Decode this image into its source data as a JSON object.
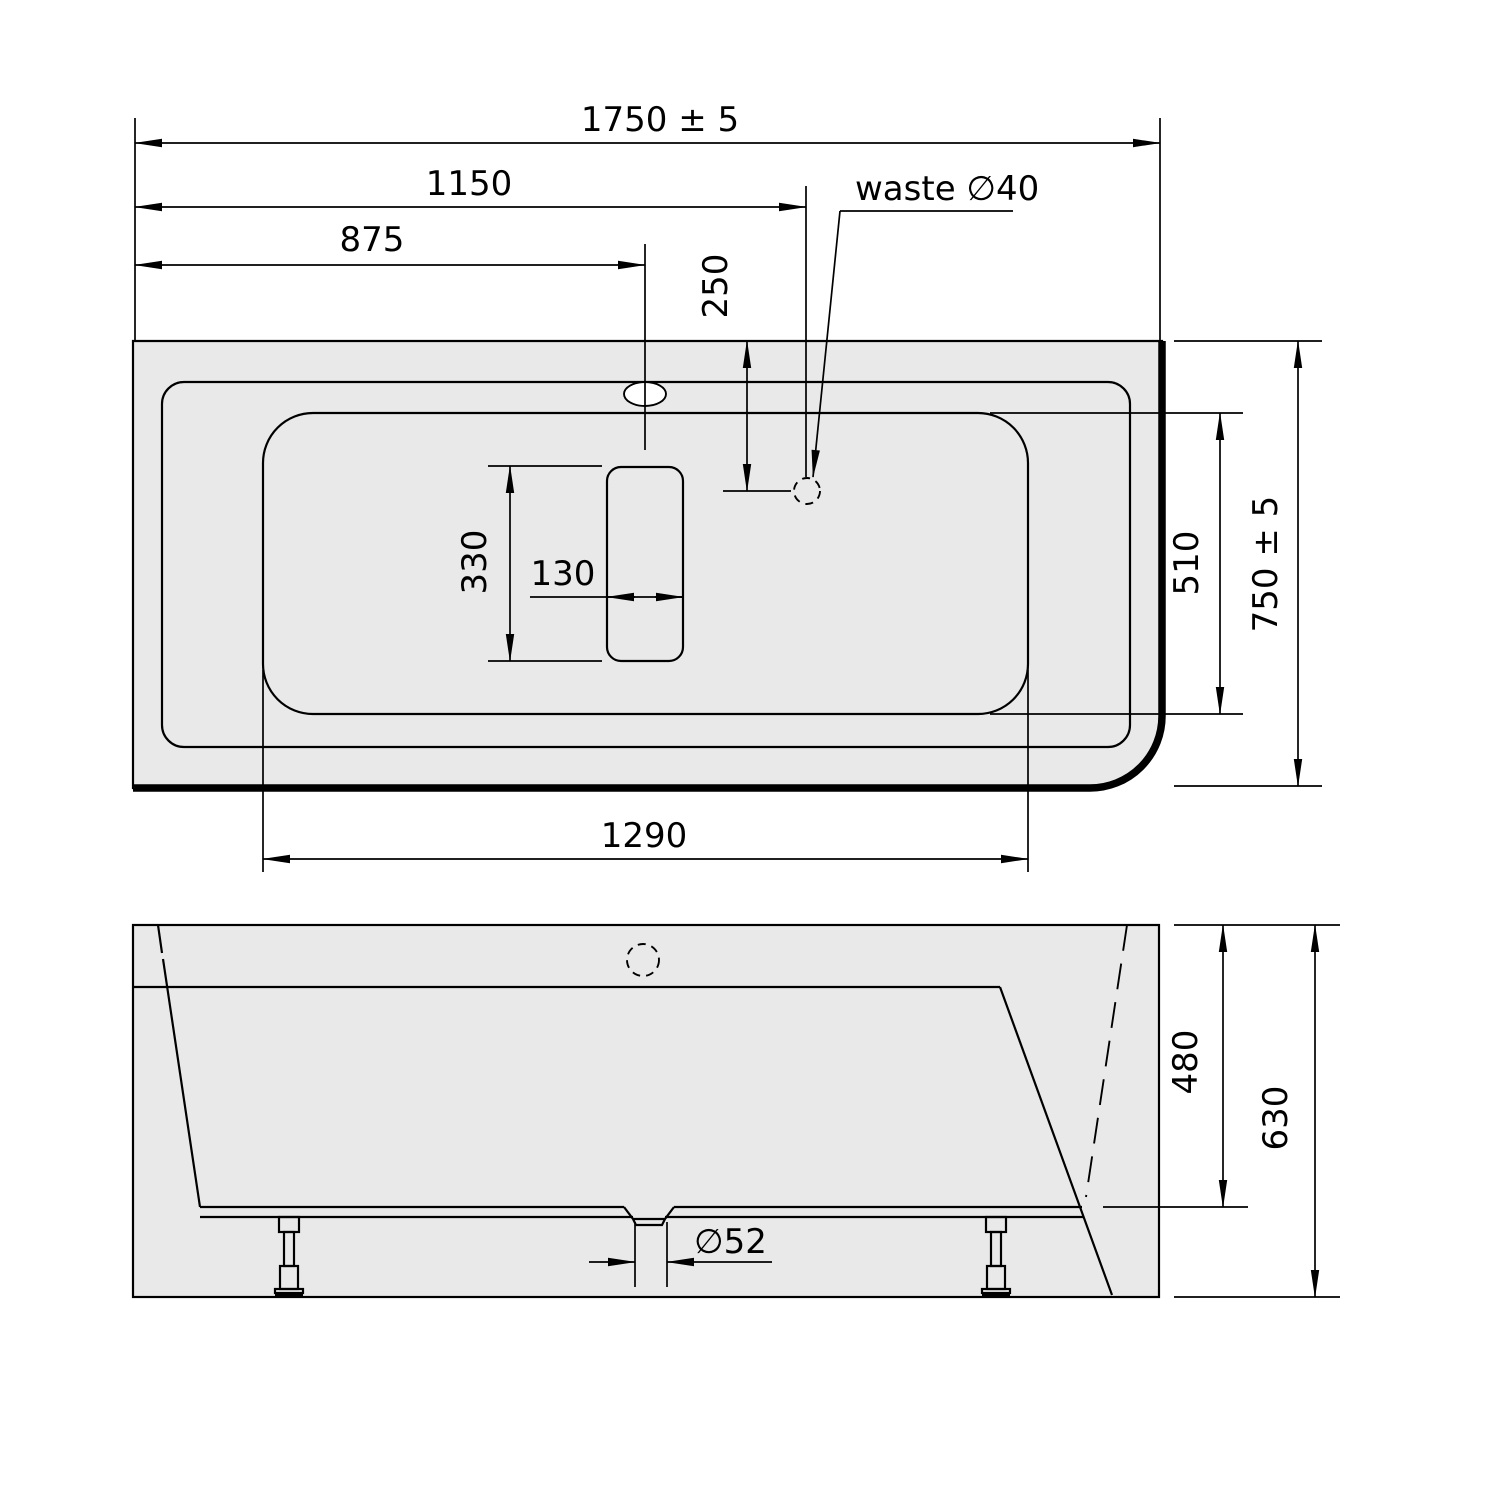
{
  "drawing": {
    "type": "technical-dimension-drawing",
    "subject": "rectangular corner bathtub, plan view and front elevation",
    "colors": {
      "body_fill": "#e9e9e9",
      "line": "#000000",
      "background": "#ffffff"
    },
    "top_view": {
      "dim_overall_length": "1750 ± 5",
      "dim_waste_from_left": "1150",
      "dim_overflow_from_left": "875",
      "dim_waste_from_top": "250",
      "waste_label": "waste ∅40",
      "dim_inner_width": "510",
      "dim_overall_width": "750 ± 5",
      "dim_inner_length": "1290",
      "dim_slot_length": "330",
      "dim_slot_width": "130"
    },
    "side_view": {
      "dim_inner_depth": "480",
      "dim_overall_height": "630",
      "dim_drain_diameter": "∅52"
    }
  }
}
